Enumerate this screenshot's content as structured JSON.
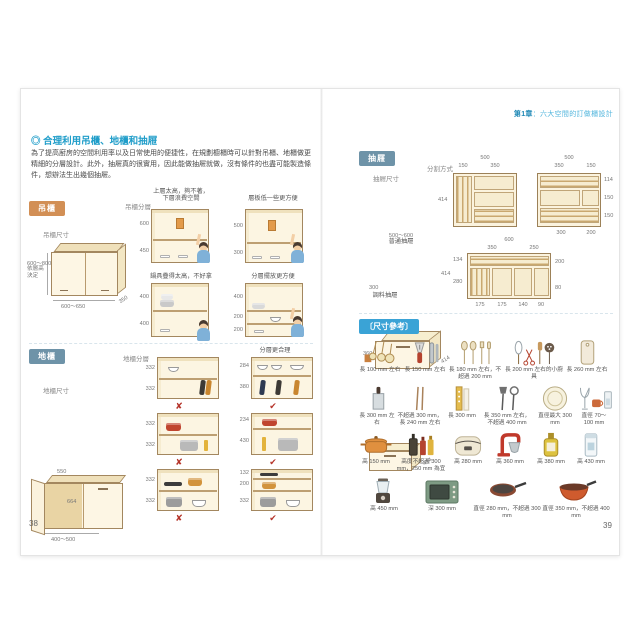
{
  "header": {
    "chapter": "第1章",
    "sep": "：",
    "title": "六大空間的訂做櫃設計"
  },
  "pages": {
    "left": "38",
    "right": "39"
  },
  "intro": {
    "title": "◎ 合理利用吊櫃、地櫃和抽屜",
    "body": "為了提高廚房的空間利用率以及日常使用的便捷性，在規劃櫥櫃時可以針對吊櫃、地櫃做更精細的分層設計。此外，抽屜真的很實用，因此能做抽屜就做，沒有條件的也盡可能製造條件，想辦法生出幾個抽屜。"
  },
  "hanging": {
    "badge": "吊櫃",
    "size_label": "吊櫃尺寸",
    "dims": {
      "height": "600～800",
      "height_note": "依層高決定",
      "width": "600～650",
      "depth": "350"
    },
    "layer_label": "吊櫃分層",
    "figs": [
      {
        "cap1": "上層太高，夠不著，",
        "cap2": "下層浪費空間",
        "d": [
          "600",
          "450"
        ]
      },
      {
        "cap1": "層板低一些更方便",
        "d": [
          "500",
          "300"
        ]
      },
      {
        "cap1": "鍋具疊得太高，不好拿",
        "d": [
          "400",
          "400"
        ]
      },
      {
        "cap1": "分層擺放更方便",
        "d": [
          "400",
          "200",
          "200"
        ]
      }
    ]
  },
  "floor": {
    "badge": "地櫃",
    "size_label": "地櫃尺寸",
    "dims": {
      "top": "550",
      "inner": "664",
      "width": "400～500"
    },
    "layer_label": "地櫃分層",
    "good_caption": "分層更合理",
    "bad_mark": "✘",
    "good_mark": "✔",
    "rows": [
      {
        "bad": [
          "332",
          "332"
        ],
        "good": [
          "284",
          "380"
        ]
      },
      {
        "bad": [
          "332",
          "332"
        ],
        "good": [
          "234",
          "430"
        ]
      },
      {
        "bad": [
          "332",
          "332"
        ],
        "good": [
          "132",
          "200",
          "332"
        ]
      }
    ]
  },
  "drawer": {
    "badge": "抽屜",
    "size_label": "抽屜尺寸",
    "split_label": "分割方式",
    "normal": {
      "h": "360",
      "depth": "414",
      "w": "500～600",
      "name": "普通抽屜"
    },
    "spice": {
      "depth": "414",
      "w": "300",
      "name": "調料抽屜"
    },
    "viewA": {
      "total": "500",
      "c1": "150",
      "c2": "350",
      "side": "414"
    },
    "viewB": {
      "total": "500",
      "c1": "350",
      "c2": "150",
      "r1": "114",
      "r2": "150",
      "r3": "150",
      "b1": "300",
      "b2": "200"
    },
    "viewC": {
      "total": "600",
      "c1": "350",
      "c2": "250",
      "side": "414",
      "l1": "134",
      "l2": "280",
      "r1": "200",
      "r2": "80",
      "b1": "175",
      "b2": "175",
      "b3": "140",
      "b4": "90"
    }
  },
  "sizeref": {
    "badge": "〔尺寸參考〕",
    "items": [
      {
        "icon": "measuring-spoons-icon",
        "label": "長 100 mm 左右"
      },
      {
        "icon": "peeler-opener-icon",
        "label": "長 150 mm 左右"
      },
      {
        "icon": "spoons-forks-icon",
        "label": "長 180 mm 左右，不超過 200 mm"
      },
      {
        "icon": "whisk-scissors-ladle-icon",
        "label": "長 200 mm 左右的小廚具"
      },
      {
        "icon": "cutting-board-icon",
        "label": "長 260 mm 左右"
      },
      {
        "icon": "kitchen-knife-icon",
        "label": "長 300 mm 左右"
      },
      {
        "icon": "chopsticks-icon",
        "label": "不超過 300 mm，長 240 mm 左右"
      },
      {
        "icon": "chopstick-box-icon",
        "label": "長 300 mm"
      },
      {
        "icon": "spatula-skimmer-icon",
        "label": "長 350 mm 左右，不超過 400 mm"
      },
      {
        "icon": "dinner-plate-icon",
        "label": "直徑最大 300 mm"
      },
      {
        "icon": "cups-glasses-icon",
        "label": "直徑 70～100 mm"
      },
      {
        "icon": "casserole-icon",
        "label": "高 150 mm"
      },
      {
        "icon": "sauce-bottles-icon",
        "label": "高度不超過 300 mm，250 mm 為宜"
      },
      {
        "icon": "rice-cooker-icon",
        "label": "高 280 mm"
      },
      {
        "icon": "stand-mixer-icon",
        "label": "高 360 mm"
      },
      {
        "icon": "oil-bottle-icon",
        "label": "高 380 mm"
      },
      {
        "icon": "tall-container-icon",
        "label": "高 430 mm"
      },
      {
        "icon": "blender-icon",
        "label": "高 450 mm"
      },
      {
        "icon": "toaster-oven-icon",
        "label": "深 300 mm"
      },
      {
        "icon": "frying-pan-icon",
        "label": "直徑 280 mm，不超過 300 mm"
      },
      {
        "icon": "wok-icon",
        "label": "直徑 350 mm，不超過 400 mm"
      }
    ]
  },
  "colors": {
    "accent_blue": "#2e9fd0",
    "badge_orange": "#d28f55",
    "badge_slate": "#6e93a8",
    "badge_blue": "#3aa3d6",
    "mark_red": "#b5342a"
  }
}
